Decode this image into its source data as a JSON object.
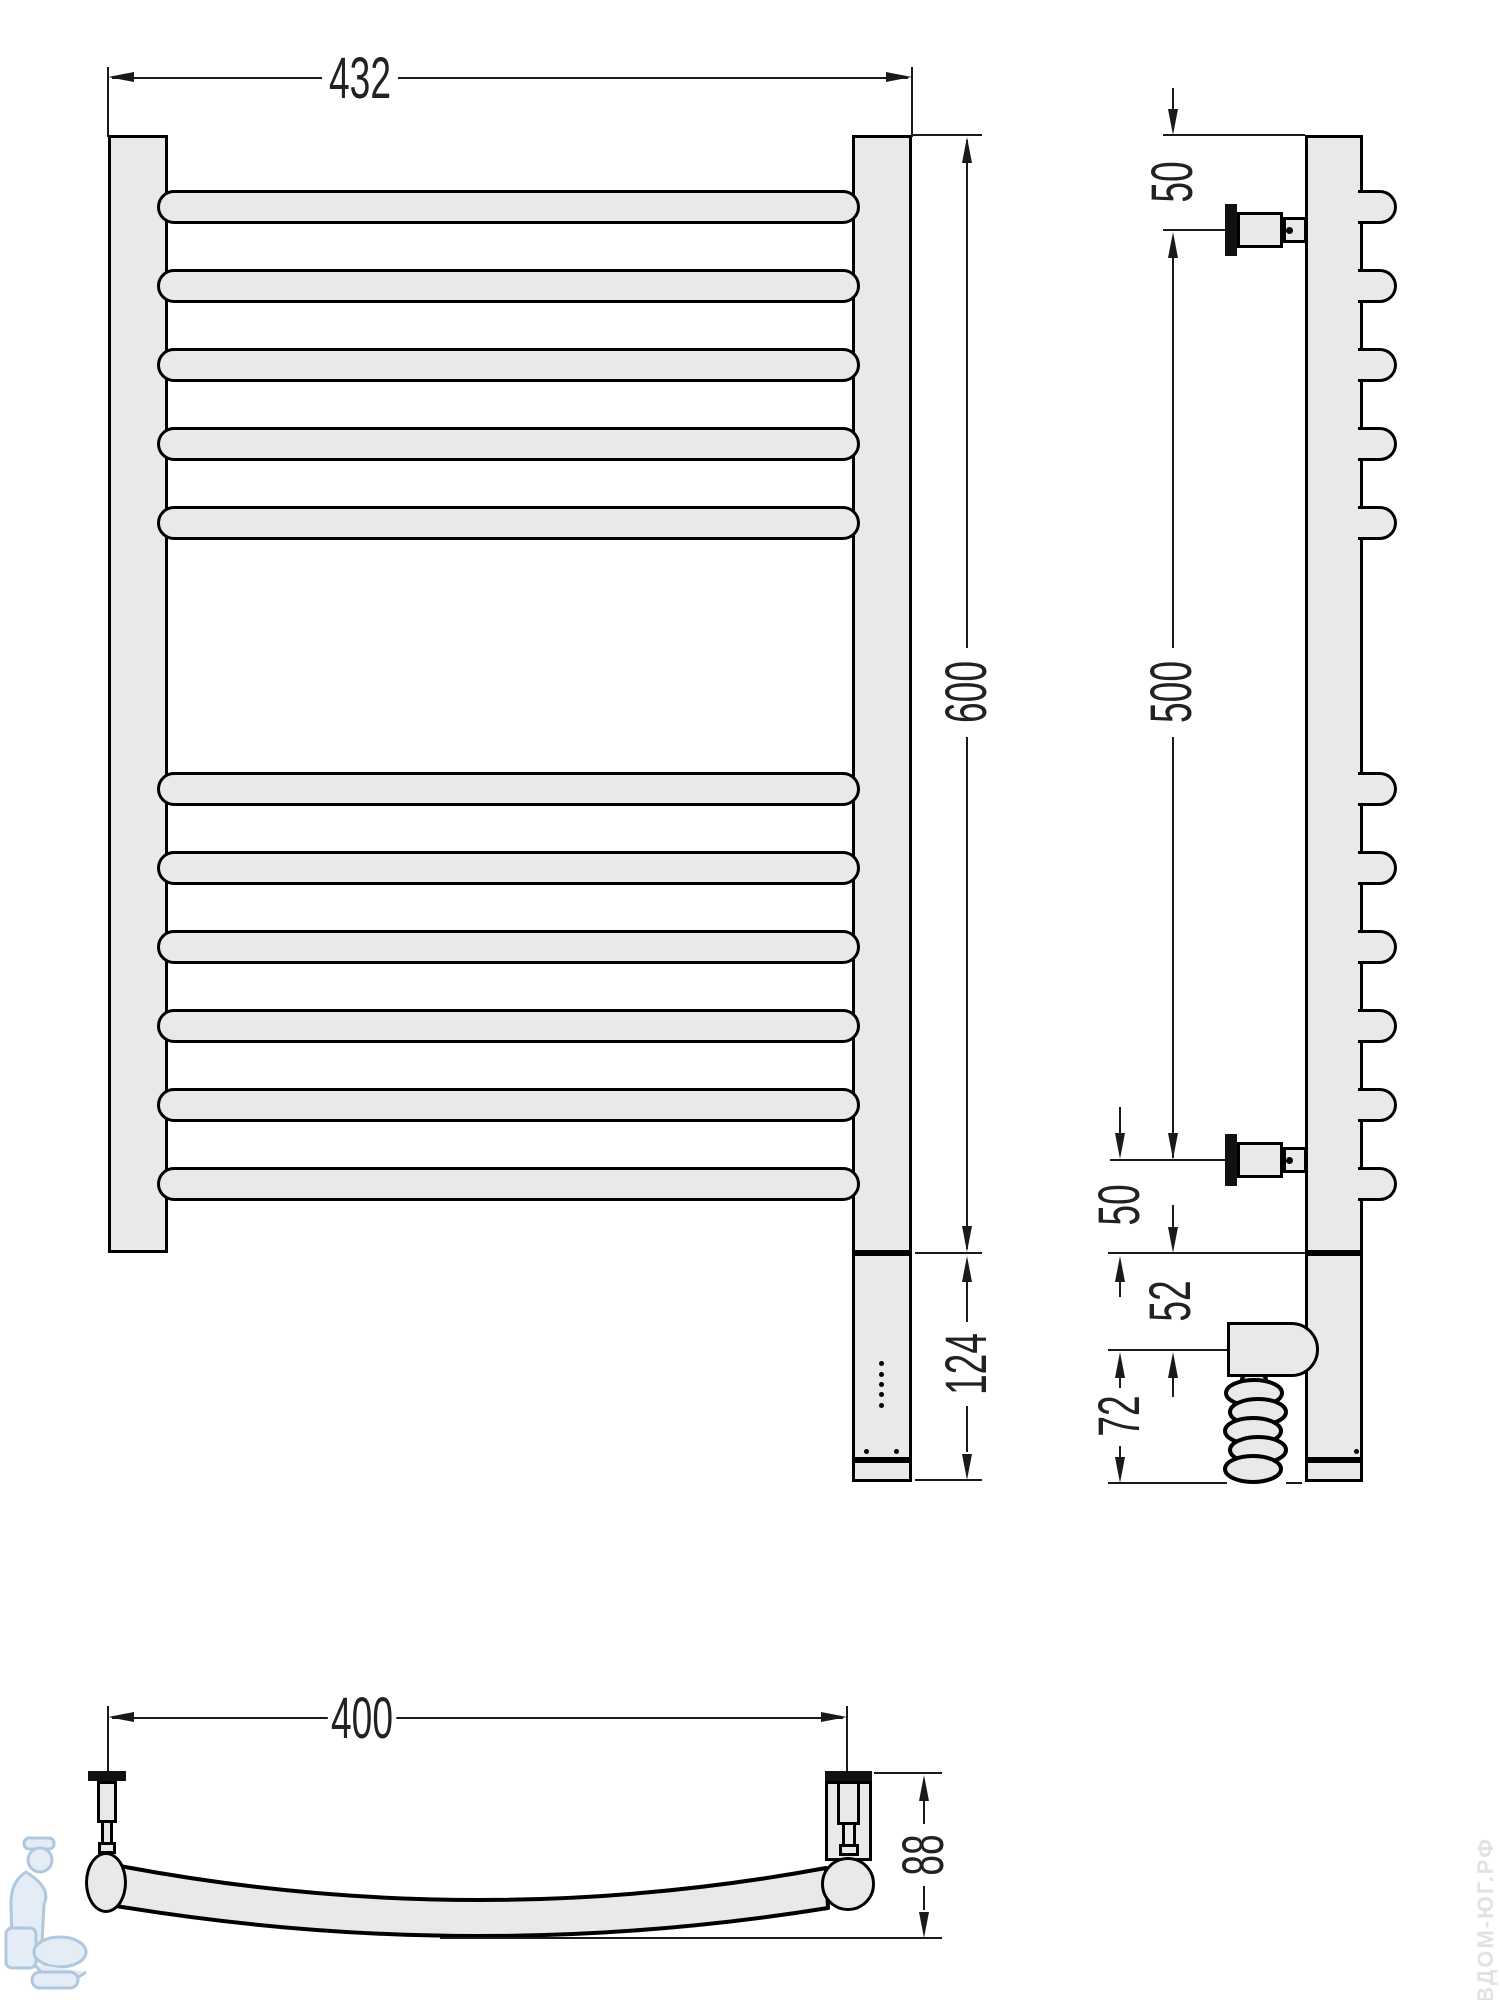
{
  "title": "Heated towel rail technical drawing, three views with dimensions",
  "views": {
    "front": {
      "width": "432",
      "height": "600",
      "heater_section": "124"
    },
    "side": {
      "top_offset": "50",
      "bracket_span": "500",
      "bottom_offset": "50",
      "element_offset": "52",
      "element_end": "72"
    },
    "bottom": {
      "bracket_span": "400",
      "depth": "88"
    }
  },
  "watermark": {
    "site": "ВДОМ-ЮГ.РФ"
  },
  "colors": {
    "part_fill": "#e9e9e9",
    "outline": "#000000",
    "dimension": "#1a1a1a",
    "watermark_blue": "#7da3c4"
  }
}
